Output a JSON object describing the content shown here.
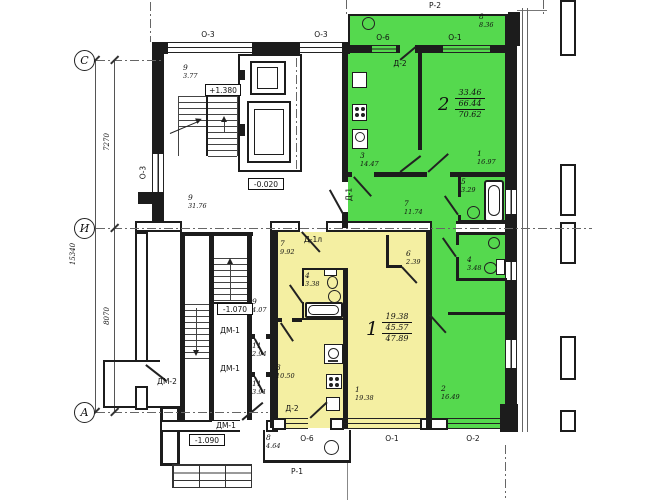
{
  "meta": {
    "drawing_type": "residential floor plan"
  },
  "colors": {
    "green": "#55D94E",
    "yellow": "#F4EFA2"
  },
  "axes": {
    "c": "С",
    "i": "И",
    "a": "А",
    "dim_top": "7270",
    "dim_bottom": "8070",
    "dim_total": "15340"
  },
  "elevations": {
    "upper": "+1.380",
    "ground": "-0.020",
    "lower": "-1.070",
    "entry": "-1.090"
  },
  "openings": {
    "p2": "Р-2",
    "p1": "Р-1",
    "o1": "О-1",
    "o2": "О-2",
    "o3": "О-3",
    "o6": "О-6",
    "d1": "Д-1",
    "d1l": "Д-1л",
    "d2": "Д-2",
    "dm1": "ДМ-1",
    "dm2": "ДМ-2"
  },
  "apt2": {
    "number": "2",
    "living": "33.46",
    "usable": "66.44",
    "total": "70.62",
    "balcony": {
      "num": "8",
      "area": "8.36"
    },
    "kitchen": {
      "num": "3",
      "area": "14.47"
    },
    "bedroom": {
      "num": "1",
      "area": "16.97"
    },
    "bath": {
      "num": "5",
      "area": "3.29"
    },
    "hall": {
      "num": "7",
      "area": "11.74"
    },
    "wc": {
      "num": "4",
      "area": "3.48"
    },
    "living_room": {
      "num": "2",
      "area": "16.49"
    }
  },
  "apt1": {
    "number": "1",
    "living": "19.38",
    "usable": "45.57",
    "total": "47.89",
    "hall": {
      "num": "7",
      "area": "9.92"
    },
    "bath": {
      "num": "4",
      "area": "3.38"
    },
    "closet": {
      "num": "6",
      "area": "2.39"
    },
    "kitchen": {
      "num": "3",
      "area": "10.50"
    },
    "living_room": {
      "num": "1",
      "area": "19.38"
    },
    "balcony": {
      "num": "8",
      "area": "4.64"
    }
  },
  "common": {
    "stair_landing_upper": {
      "num": "9",
      "area": "3.77"
    },
    "corridor": {
      "num": "9",
      "area": "31.76"
    },
    "stair_landing_lower": {
      "num": "9",
      "area": "4.07"
    },
    "vestibule_1": {
      "num": "11",
      "area": "2.94"
    },
    "vestibule_2": {
      "num": "11",
      "area": "3.91"
    }
  }
}
